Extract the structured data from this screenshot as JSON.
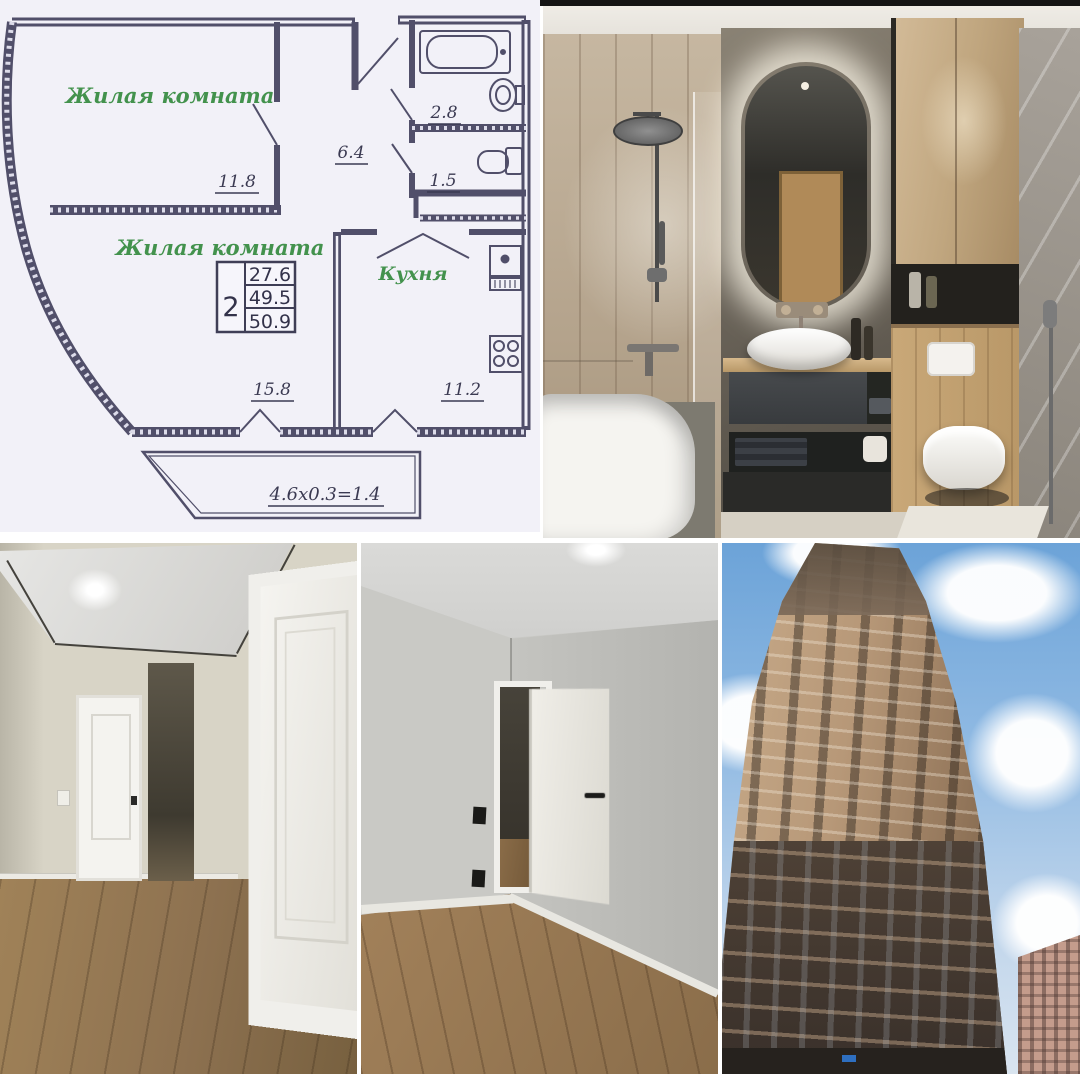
{
  "colors": {
    "plan_line": "#514f6a",
    "plan_label_green": "#43924d",
    "plan_paper": "#f2f1f8",
    "sky_blue": "#6ca3d8",
    "wood_floor": "#9a7c57",
    "facade_tan": "#b79878"
  },
  "floor_plan": {
    "room1_label": "Жилая комната",
    "room1_area": "11.8",
    "bath_area": "2.8",
    "hall_area": "6.4",
    "wc_area": "1.5",
    "room2_label": "Жилая комната",
    "room2_area": "15.8",
    "kitchen_label": "Кухня",
    "kitchen_area": "11.2",
    "table": {
      "rooms": "2",
      "row1": "27.6",
      "row2": "49.5",
      "row3": "50.9"
    },
    "balcony_dim": "4.6x0.3=1.4"
  }
}
